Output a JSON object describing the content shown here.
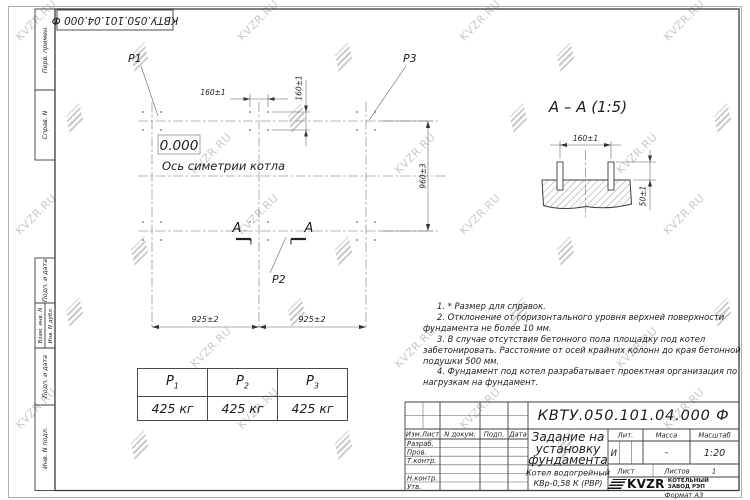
{
  "watermark": {
    "text": "KVZR.RU"
  },
  "top_stamp": {
    "designation": "КВТУ.050.101.04.000 Ф"
  },
  "margin": {
    "perv_primen": "Перв. примен.",
    "sprav_n": "Справ. N",
    "podp_data_1": "Подп. и дата",
    "vzam_inv": "Взам. инв. N",
    "inv_dubl": "Инв. N дубл.",
    "podp_data_2": "Подп. и дата",
    "inv_podl": "Инв. N подл."
  },
  "plan": {
    "p1": "P1",
    "p2": "P2",
    "p3": "P3",
    "zero_mark": "0.000",
    "axis_label": "Ось симетрии котла",
    "section_letter": "A",
    "dim_160_h": "160±1",
    "dim_160_v": "160±1",
    "dim_925_left": "925±2",
    "dim_925_right": "925±2",
    "dim_960": "960±3"
  },
  "section_view": {
    "title": "A – A (1:5)",
    "dim_160": "160±1",
    "dim_50": "50±1"
  },
  "notes": {
    "items": [
      "1. * Размер для справок.",
      "2. Отклонение от горизонтального уровня верхней поверхности фундамента не более 10 мм.",
      "3. В случае отсутствия бетонного пола площадку под котел забетонировать. Расстояние от осей крайних колонн до края бетонной подушки 500 мм.",
      "4. Фундамент под котел разрабатывает проектная организация по нагрузкам на фундамент."
    ]
  },
  "load_table": {
    "columns": [
      {
        "name": "P",
        "sub": "1",
        "value": "425 кг"
      },
      {
        "name": "P",
        "sub": "2",
        "value": "425 кг"
      },
      {
        "name": "P",
        "sub": "3",
        "value": "425 кг"
      }
    ]
  },
  "title_block": {
    "designation": "КВТУ.050.101.04.000 Ф",
    "title_lines": [
      "Задание на",
      "установку",
      "фундамента"
    ],
    "product_lines": [
      "Котел водогрейный",
      "КВр-0,58 К (РВР)"
    ],
    "header_cells": [
      "Изм.Лист",
      "N докум.",
      "Подп.",
      "Дата"
    ],
    "row_labels": [
      "Разраб.",
      "Пров.",
      "Т.контр.",
      "Н.контр.",
      "Утв."
    ],
    "lit_label": "Лит.",
    "lit_value": "И",
    "mass_label": "Масса",
    "mass_value": "–",
    "scale_label": "Масштаб",
    "scale_value": "1:20",
    "sheet_label": "Лист",
    "sheets_label": "Листов",
    "sheets_value": "1",
    "logo_text": "KVZR",
    "company_lines": [
      "КОТЕЛЬНЫЙ",
      "ЗАВОД РЭП"
    ],
    "format_note": "Формат А3"
  }
}
